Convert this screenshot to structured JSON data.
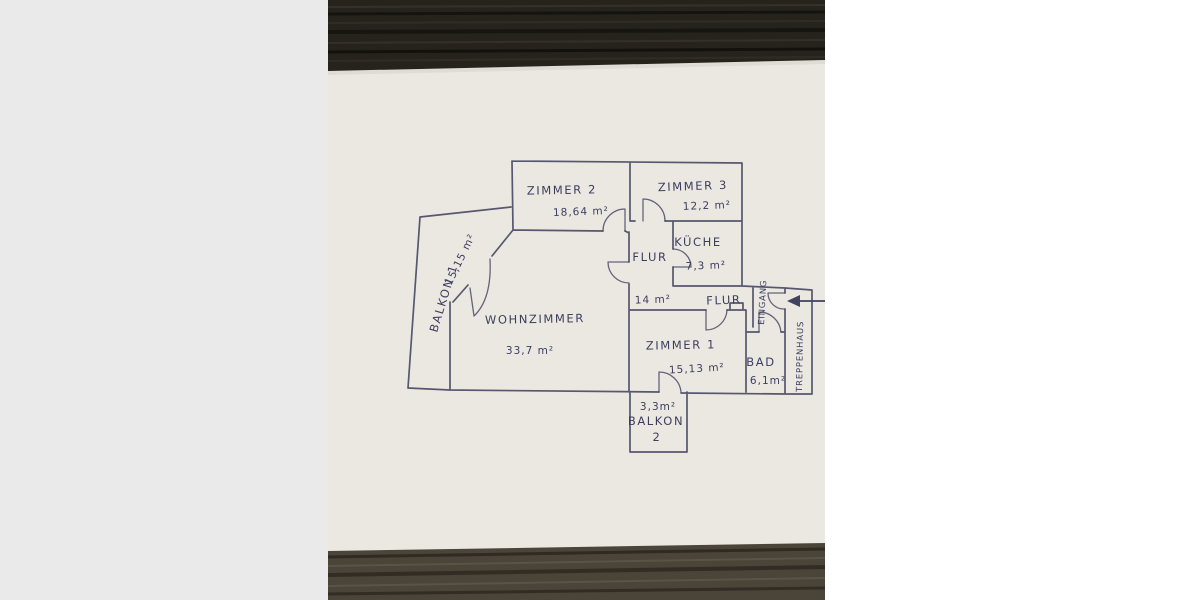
{
  "floor_plan": {
    "labels": {
      "zimmer2": "ZIMMER 2",
      "zimmer2_area": "18,64 m²",
      "zimmer3": "ZIMMER 3",
      "zimmer3_area": "12,2 m²",
      "kueche": "KÜCHE",
      "kueche_area": "7,3 m²",
      "flur_main": "FLUR",
      "flur_main_area": "14 m²",
      "flur_entry": "FLUR",
      "wohnzimmer": "WOHNZIMMER",
      "wohnzimmer_area": "33,7 m²",
      "zimmer1": "ZIMMER 1",
      "zimmer1_area": "15,13 m²",
      "bad": "BAD",
      "bad_area": "6,1m²",
      "balkon1": "BALKON 1",
      "balkon1_area": "15,15 m²",
      "balkon2_area": "3,3m²",
      "balkon2_name": "BALKON",
      "balkon2_number": "2",
      "eingang": "EINGANG",
      "treppenhaus": "TREPPENHAUS"
    },
    "icons": {
      "entrance_arrow": "left-arrow"
    },
    "colors": {
      "ink": "#42425f",
      "paper": "#ebe8e2",
      "wood_top": "#26231d",
      "wood_bottom": "#4a4439",
      "pad_left": "#eaeaea",
      "pad_right": "#ffffff"
    }
  }
}
